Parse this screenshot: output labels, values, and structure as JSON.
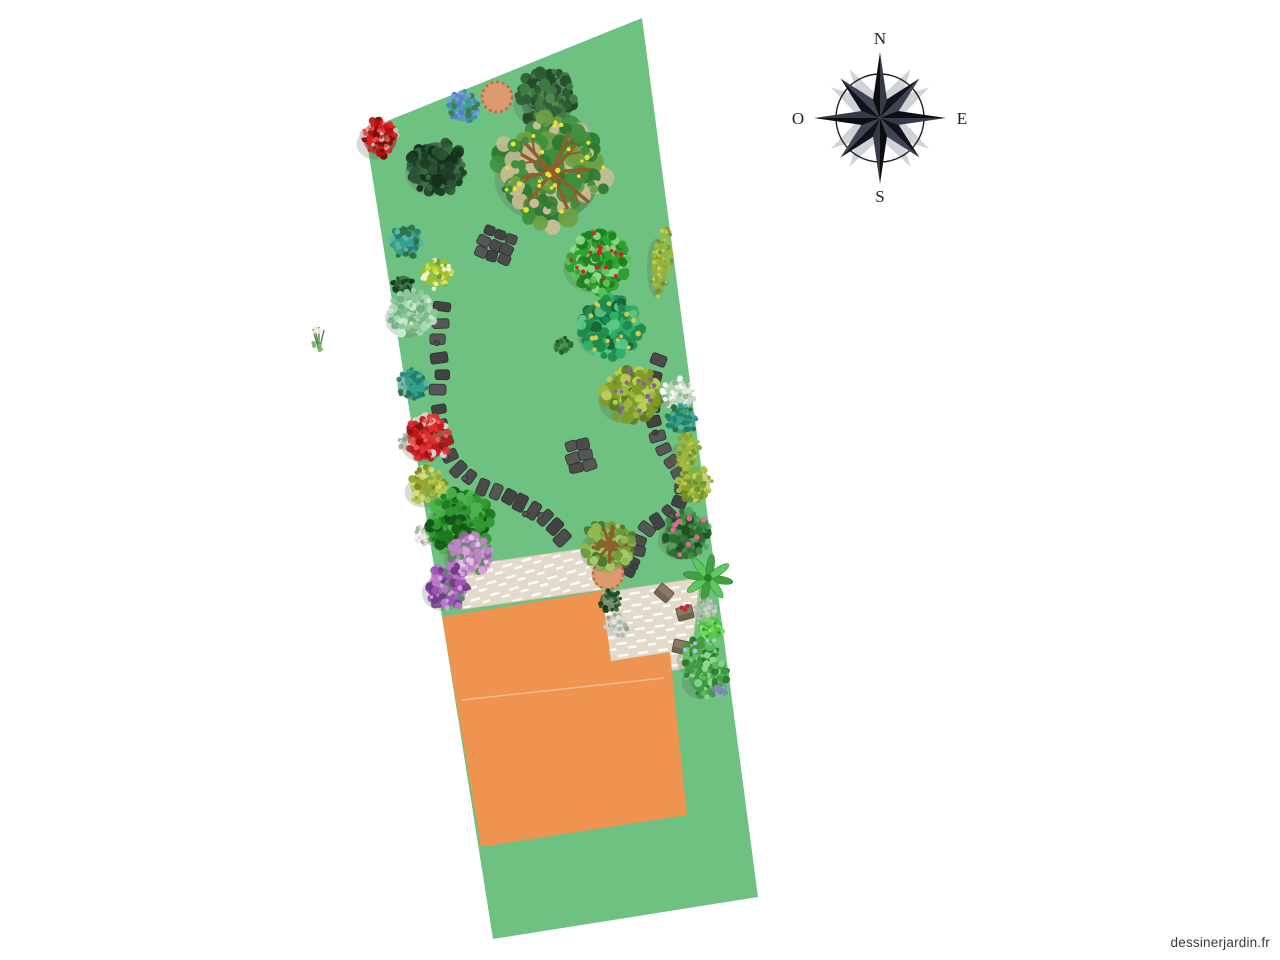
{
  "meta": {
    "watermark": "dessinerjardin.fr"
  },
  "canvas": {
    "width": 1280,
    "height": 960
  },
  "colors": {
    "plot": "#6EC180",
    "house": "#EF9350",
    "terrace": "#E2DACA",
    "terrace_edge": "#CFC6B4",
    "stone": "#4B4B4B",
    "stone_alt": "#424242",
    "stone_light": "#565656",
    "stone_border": "#313131",
    "pot": "#DD9A6F",
    "pot_rim": "#B0744B",
    "chair": "#8A7B63",
    "chair_dark": "#6F614B",
    "branch": "#8F5D2E",
    "compass_dark": "#0B0D11",
    "compass_mid": "#343B47",
    "compass_shadow": "#8A93A0"
  },
  "compass": {
    "cx": 880,
    "cy": 118,
    "ring_r": 44,
    "cardinal_len": 66,
    "diagonal_len": 56,
    "labels": {
      "north": "N",
      "east": "E",
      "south": "S",
      "west": "O"
    }
  },
  "garden": {
    "plot": {
      "points": [
        [
          365,
          130
        ],
        [
          642,
          18
        ],
        [
          758,
          897
        ],
        [
          493,
          939
        ]
      ]
    },
    "house": {
      "points": [
        [
          442,
          617
        ],
        [
          602,
          591
        ],
        [
          611,
          661
        ],
        [
          670,
          652
        ],
        [
          687,
          815
        ],
        [
          481,
          847
        ]
      ],
      "divider": [
        [
          462,
          700
        ],
        [
          664,
          678
        ]
      ]
    },
    "terrace_upper": {
      "cx": 530,
      "cy": 578,
      "w": 142,
      "h": 43,
      "rot": -8
    },
    "terrace_right": {
      "points": [
        [
          600,
          593
        ],
        [
          700,
          578
        ],
        [
          690,
          668
        ],
        [
          609,
          678
        ]
      ]
    },
    "pots": [
      {
        "cx": 497,
        "cy": 97,
        "r": 16
      },
      {
        "cx": 608,
        "cy": 574,
        "r": 16
      }
    ],
    "stone_paths": [
      {
        "name": "path-left",
        "pts": [
          [
            441,
            306
          ],
          [
            440,
            323
          ],
          [
            439,
            340
          ],
          [
            440,
            357
          ],
          [
            441,
            374
          ],
          [
            439,
            391
          ],
          [
            438,
            408
          ],
          [
            441,
            425
          ],
          [
            445,
            441
          ],
          [
            450,
            456
          ],
          [
            459,
            468
          ],
          [
            470,
            478
          ],
          [
            482,
            486
          ],
          [
            495,
            492
          ],
          [
            508,
            498
          ],
          [
            521,
            504
          ],
          [
            533,
            511
          ],
          [
            544,
            519
          ],
          [
            554,
            528
          ],
          [
            562,
            538
          ]
        ]
      },
      {
        "name": "path-right",
        "pts": [
          [
            658,
            361
          ],
          [
            654,
            377
          ],
          [
            651,
            392
          ],
          [
            650,
            407
          ],
          [
            653,
            422
          ],
          [
            658,
            436
          ],
          [
            664,
            449
          ],
          [
            672,
            461
          ],
          [
            679,
            474
          ],
          [
            682,
            488
          ],
          [
            678,
            502
          ],
          [
            669,
            513
          ],
          [
            658,
            521
          ],
          [
            647,
            529
          ],
          [
            640,
            540
          ],
          [
            636,
            552
          ],
          [
            633,
            563
          ],
          [
            628,
            571
          ]
        ]
      }
    ],
    "stone_clusters": [
      {
        "name": "stones-upper",
        "cx": 496,
        "cy": 245,
        "rows": 3,
        "cols": 3,
        "sw": 10,
        "sh": 9,
        "gap": 2,
        "rot": 20
      },
      {
        "name": "stones-middle",
        "cx": 580,
        "cy": 456,
        "rows": 3,
        "cols": 2,
        "sw": 11,
        "sh": 9,
        "gap": 2,
        "rot": -14
      }
    ],
    "chairs": [
      {
        "cx": 664,
        "cy": 593,
        "rot": 40
      },
      {
        "cx": 685,
        "cy": 613,
        "rot": -15,
        "accent": "#C2283C"
      },
      {
        "cx": 681,
        "cy": 647,
        "rot": 12
      }
    ],
    "plants": [
      {
        "name": "lupine-sprig",
        "type": "sprig",
        "cx": 319,
        "cy": 341,
        "r": 12,
        "colors": [
          "#5A8F4A",
          "#7FB86F",
          "#E8E8E0"
        ]
      },
      {
        "name": "red-shrub",
        "cx": 380,
        "cy": 138,
        "r": 20,
        "colors": [
          "#B31212",
          "#E02020",
          "#7A0C0C",
          "#C8C8C8"
        ],
        "dots": "#E84848"
      },
      {
        "name": "blue-hydrangea",
        "cx": 463,
        "cy": 107,
        "r": 17,
        "colors": [
          "#4F7FD0",
          "#74A0E0",
          "#2E9E8F",
          "#3E7C46"
        ]
      },
      {
        "name": "dark-green-tree",
        "cx": 546,
        "cy": 98,
        "r": 30,
        "colors": [
          "#2E5D33",
          "#3F7A45",
          "#24492A",
          "#518A56"
        ]
      },
      {
        "name": "dark-dense-bush",
        "cx": 437,
        "cy": 167,
        "r": 29,
        "colors": [
          "#1E3D26",
          "#2C5435",
          "#16301C",
          "#3A6B42"
        ]
      },
      {
        "name": "large-branched-tree",
        "cx": 552,
        "cy": 172,
        "r": 57,
        "branches": true,
        "colors": [
          "#3E8F3E",
          "#2F7A33",
          "#C9BC96",
          "#6FA046"
        ],
        "dots": "#E6E62E"
      },
      {
        "name": "teal-shrub",
        "cx": 406,
        "cy": 242,
        "r": 17,
        "colors": [
          "#1F7F74",
          "#2FA195",
          "#2F6E3F",
          "#57B7A8"
        ]
      },
      {
        "name": "apple-tree",
        "cx": 598,
        "cy": 262,
        "r": 32,
        "colors": [
          "#2EA12E",
          "#55C655",
          "#1F7F1F",
          "#8FD98F"
        ],
        "dots": "#D92121"
      },
      {
        "name": "hedge-column",
        "cx": 662,
        "cy": 262,
        "rx": 11,
        "ry": 38,
        "rot": 7,
        "colors": [
          "#A8B832",
          "#8FA428",
          "#C3D04C",
          "#6F8F3A"
        ]
      },
      {
        "name": "yellow-flower-shrub",
        "cx": 437,
        "cy": 274,
        "r": 16,
        "colors": [
          "#A3C020",
          "#C9DC3C",
          "#7E9C28",
          "#EDEDC8"
        ],
        "dots": "#F2F2C8"
      },
      {
        "name": "small-dark-bush",
        "cx": 403,
        "cy": 285,
        "r": 11,
        "colors": [
          "#1C4224",
          "#2C5E33",
          "#123018"
        ]
      },
      {
        "name": "pale-green-tree",
        "cx": 412,
        "cy": 313,
        "r": 24,
        "colors": [
          "#8FC79A",
          "#A9D8B2",
          "#6FAF7E",
          "#CBE8D0"
        ]
      },
      {
        "name": "emerald-tree",
        "cx": 611,
        "cy": 327,
        "r": 32,
        "colors": [
          "#1F8A4C",
          "#2FB066",
          "#14623A",
          "#59C98B"
        ],
        "dots": "#D8C84A"
      },
      {
        "name": "tiny-bush",
        "cx": 563,
        "cy": 345,
        "r": 9,
        "colors": [
          "#2F6E33",
          "#4A8F4E",
          "#1F4F24"
        ]
      },
      {
        "name": "olive-tree",
        "cx": 631,
        "cy": 394,
        "r": 30,
        "colors": [
          "#7E9C28",
          "#9DB83C",
          "#5C7A20",
          "#BBD058"
        ],
        "dots": "#8A5FA0"
      },
      {
        "name": "teal-shrub-2",
        "cx": 412,
        "cy": 385,
        "r": 17,
        "colors": [
          "#1F7F74",
          "#2FA195",
          "#2F6E3F",
          "#57B7A8"
        ]
      },
      {
        "name": "white-flower-shrub",
        "cx": 678,
        "cy": 394,
        "r": 17,
        "colors": [
          "#E8E8E0",
          "#CFCFC4",
          "#8FAE84",
          "#FFFFFF"
        ]
      },
      {
        "name": "teal-shrub-3",
        "cx": 682,
        "cy": 420,
        "r": 16,
        "colors": [
          "#1F7F74",
          "#2FA195",
          "#2F6E3F",
          "#57B7A8"
        ]
      },
      {
        "name": "yellow-hedge",
        "cx": 687,
        "cy": 452,
        "rx": 13,
        "ry": 20,
        "rot": 7,
        "colors": [
          "#A8B832",
          "#8FA428",
          "#C3D04C",
          "#6F8F3A"
        ]
      },
      {
        "name": "olive-shrub",
        "cx": 694,
        "cy": 483,
        "r": 19,
        "colors": [
          "#8FA428",
          "#A8C040",
          "#6F8F2E",
          "#C8D860"
        ]
      },
      {
        "name": "white-flowers",
        "cx": 408,
        "cy": 443,
        "r": 10,
        "colors": [
          "#E0E0DC",
          "#C6C6C0",
          "#9FB597"
        ]
      },
      {
        "name": "red-roses",
        "cx": 428,
        "cy": 438,
        "r": 24,
        "colors": [
          "#C01818",
          "#E03030",
          "#8F1010",
          "#D8D8D8"
        ],
        "dots": "#F05858"
      },
      {
        "name": "olive-foliage",
        "cx": 428,
        "cy": 486,
        "r": 20,
        "colors": [
          "#9AA832",
          "#B8C84C",
          "#78881F",
          "#D4DE7A"
        ]
      },
      {
        "name": "white-flowers-2",
        "cx": 424,
        "cy": 535,
        "r": 11,
        "colors": [
          "#E4E4DE",
          "#CACAC2",
          "#9FB597"
        ]
      },
      {
        "name": "green-shrub",
        "cx": 460,
        "cy": 523,
        "r": 33,
        "colors": [
          "#1F7A1F",
          "#2F9A2F",
          "#145514",
          "#4FB54F"
        ]
      },
      {
        "name": "mauve-flowers",
        "cx": 470,
        "cy": 553,
        "r": 23,
        "colors": [
          "#C083C8",
          "#D8A2DC",
          "#9A5FA5",
          "#4F8F4F"
        ],
        "dots": "#E6C0EA"
      },
      {
        "name": "violet-flowers",
        "cx": 448,
        "cy": 587,
        "r": 23,
        "colors": [
          "#9A55B0",
          "#B878C8",
          "#6E3A85",
          "#4F8F4F"
        ],
        "dots": "#CFA0DE"
      },
      {
        "name": "pink-rose-shrub",
        "cx": 686,
        "cy": 534,
        "r": 25,
        "colors": [
          "#2F6E33",
          "#3F8A43",
          "#1F4F24",
          "#57A05C"
        ],
        "dots": "#E8649A"
      },
      {
        "name": "palm-plant",
        "type": "palm",
        "cx": 708,
        "cy": 578,
        "r": 24,
        "colors": [
          "#3FA23F",
          "#5FC75F",
          "#2A7F2A"
        ]
      },
      {
        "name": "potted-tree",
        "cx": 610,
        "cy": 545,
        "r": 27,
        "branches": true,
        "colors": [
          "#6F9F3A",
          "#8FB850",
          "#4F7A2A",
          "#A8C870"
        ]
      },
      {
        "name": "dark-spiky-plant",
        "cx": 610,
        "cy": 601,
        "r": 12,
        "colors": [
          "#1E4A24",
          "#2F6E33",
          "#123018"
        ]
      },
      {
        "name": "agave-plant",
        "cx": 616,
        "cy": 625,
        "r": 13,
        "colors": [
          "#C8CFC4",
          "#AEB8AA",
          "#8F9E8A",
          "#E4E8E0"
        ]
      },
      {
        "name": "gray-foliage",
        "cx": 705,
        "cy": 610,
        "r": 13,
        "colors": [
          "#B8BEB2",
          "#D0D4CC",
          "#8FA284"
        ]
      },
      {
        "name": "bright-green-shrub",
        "cx": 710,
        "cy": 628,
        "r": 14,
        "colors": [
          "#4FC43F",
          "#6FDC5A",
          "#2F9E24",
          "#9AE88A"
        ]
      },
      {
        "name": "mixed-green-shrub",
        "cx": 700,
        "cy": 655,
        "r": 20,
        "colors": [
          "#3F9A3F",
          "#5FBB5F",
          "#2A7A2A",
          "#7FCF7F"
        ],
        "dots": "#A8C0E8"
      },
      {
        "name": "green-tree-lower",
        "cx": 707,
        "cy": 676,
        "r": 22,
        "colors": [
          "#3F9A43",
          "#5FBB63",
          "#2A7A2E",
          "#8FD890"
        ]
      },
      {
        "name": "blue-gray-item",
        "cx": 720,
        "cy": 690,
        "r": 7,
        "colors": [
          "#7A8FA8",
          "#9AACC0",
          "#5A708A"
        ]
      }
    ]
  }
}
